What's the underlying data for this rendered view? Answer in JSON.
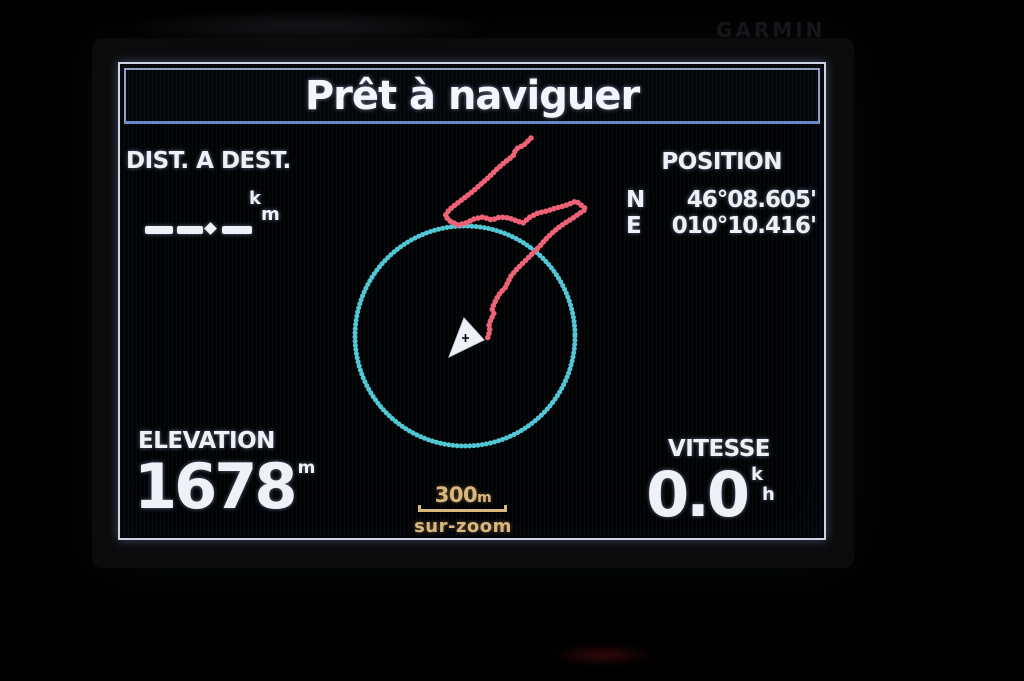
{
  "device": {
    "brand_logo": "GARMIN"
  },
  "title_bar": {
    "title": "Prêt à naviguer"
  },
  "dist_dest": {
    "label": "DIST. A DEST.",
    "unit_top": "k",
    "unit_bottom": "m",
    "value_state": "blank"
  },
  "position": {
    "label": "POSITION",
    "lat_dir": "N",
    "lat": "46°08.605'",
    "lon_dir": "E",
    "lon": "010°10.416'"
  },
  "elevation": {
    "label": "ELEVATION",
    "value": "1678",
    "unit": "m"
  },
  "speed": {
    "label": "VITESSE",
    "value": "0.0",
    "unit_top": "k",
    "unit_bottom": "h"
  },
  "map": {
    "scale_value": "300",
    "scale_unit": "m",
    "zoom_label": "sur-zoom",
    "compass": {
      "cx": "345",
      "cy": "272",
      "r": "110"
    },
    "track_points": "411,74 404,81 396,85 393,92 385,98 377,105 369,113 360,121 352,128 343,135 335,141 329,146 325,152 330,157 338,161 346,159 354,155 363,153 372,156 380,153 389,154 397,157 403,159 410,153 418,149 427,147 436,144 444,142 452,139 456,137 461,141 466,145 460,149 453,154 445,159 438,164 431,170 425,176 420,182 414,188 408,194 402,200 396,206 391,212 388,218 385,224 380,229 377,234 374,240 372,245 374,250 371,255 369,261 370,267 368,272 367,277",
    "arrow_points": "344,254 364,276 329,293"
  },
  "colors": {
    "track_pink": "#ee6176",
    "compass_cyan": "#55d2e0",
    "scale_amber": "#d9b77c",
    "text_white": "#eef2f8",
    "cursor_black": "#000000"
  }
}
